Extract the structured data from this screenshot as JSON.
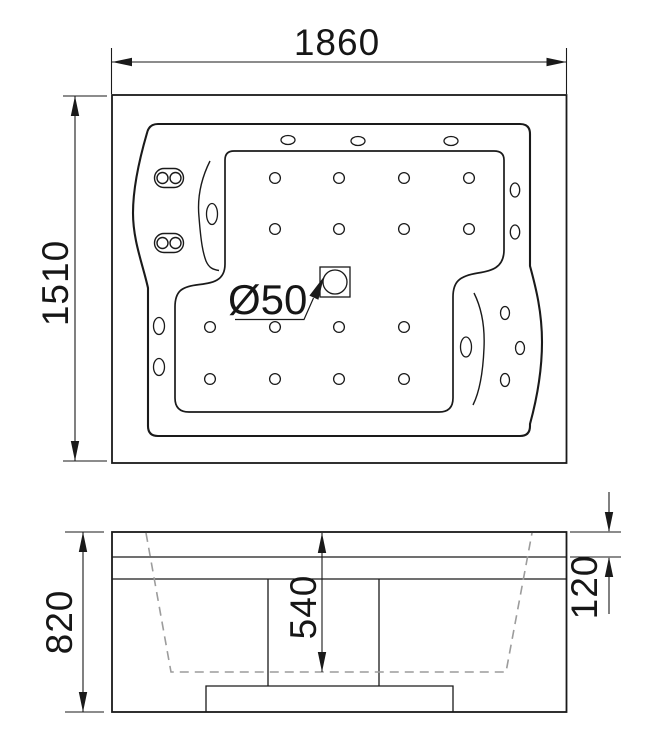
{
  "drawing": {
    "title": "bathtub-technical-drawing",
    "background": "#ffffff",
    "line_color": "#1a1a1a",
    "hidden_line_color": "#9c9c9c",
    "labels": {
      "overall_width": "1860",
      "overall_depth": "1510",
      "overall_height": "820",
      "basin_depth": "540",
      "rim_height": "120",
      "drain": "Ø50"
    },
    "jets": {
      "floor_jet_radius": 5.4,
      "floor_jets": [
        [
          275,
          178
        ],
        [
          339,
          178
        ],
        [
          404,
          178
        ],
        [
          469,
          178
        ],
        [
          275,
          229
        ],
        [
          339,
          229
        ],
        [
          404,
          229
        ],
        [
          469,
          229
        ],
        [
          210,
          327
        ],
        [
          275,
          327
        ],
        [
          339,
          327
        ],
        [
          404,
          327
        ],
        [
          210,
          379
        ],
        [
          275,
          379
        ],
        [
          339,
          379
        ],
        [
          404,
          379
        ]
      ],
      "deck_ovals": [
        {
          "cx": 288,
          "cy": 140,
          "rx": 7,
          "ry": 4.5
        },
        {
          "cx": 358,
          "cy": 141,
          "rx": 7,
          "ry": 4.5
        },
        {
          "cx": 451,
          "cy": 141,
          "rx": 7,
          "ry": 4.5
        },
        {
          "cx": 515,
          "cy": 190,
          "rx": 4.7,
          "ry": 7
        },
        {
          "cx": 515,
          "cy": 232,
          "rx": 4.7,
          "ry": 7
        },
        {
          "cx": 505,
          "cy": 313,
          "rx": 4.5,
          "ry": 6.5
        },
        {
          "cx": 520,
          "cy": 348,
          "rx": 4.5,
          "ry": 6.5
        },
        {
          "cx": 505,
          "cy": 380,
          "rx": 4.5,
          "ry": 6.5
        },
        {
          "cx": 159,
          "cy": 326,
          "rx": 5.5,
          "ry": 8.5
        },
        {
          "cx": 159,
          "cy": 367,
          "rx": 5.5,
          "ry": 8.5
        },
        {
          "cx": 212,
          "cy": 214,
          "rx": 5.5,
          "ry": 10.5
        },
        {
          "cx": 466,
          "cy": 347,
          "rx": 5.5,
          "ry": 10
        }
      ],
      "headrest_jets": [
        {
          "cx": 169,
          "cy": 178
        },
        {
          "cx": 169,
          "cy": 243
        }
      ]
    }
  }
}
